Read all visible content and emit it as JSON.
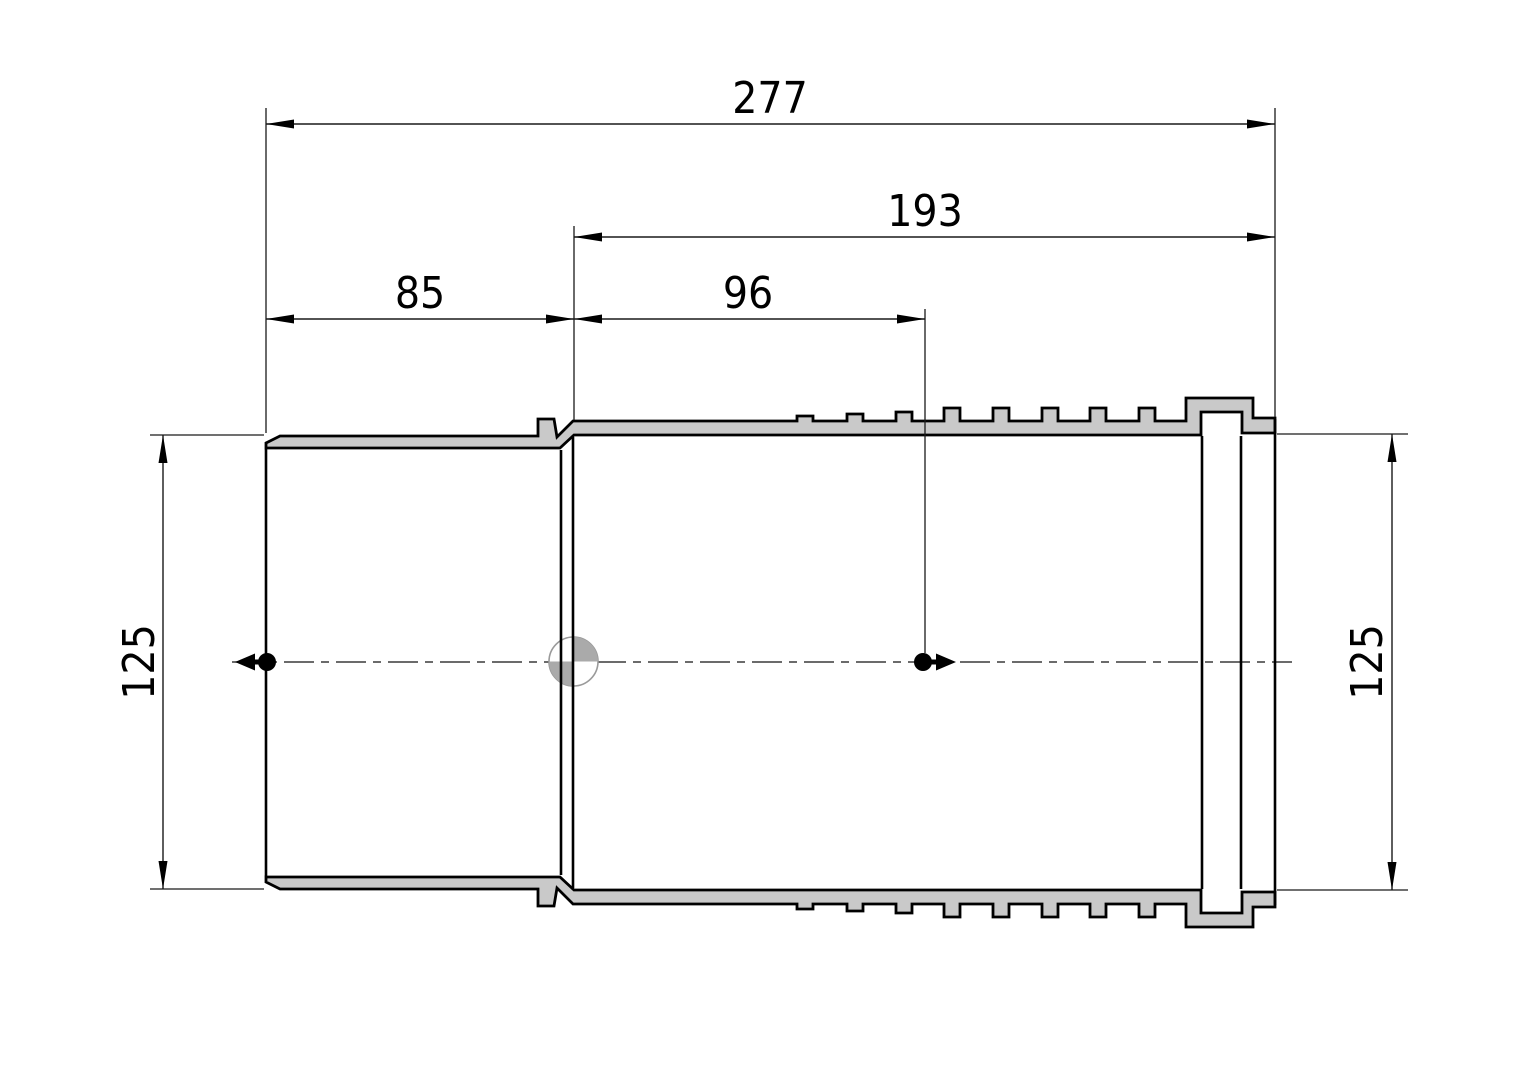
{
  "drawing": {
    "type": "technical-section-drawing",
    "subject": "pipe-adapter-sleeve-cross-section",
    "dimensions": {
      "overall_length": "277",
      "ribbed_section_length": "193",
      "socket_section_length": "85",
      "marker_offset_length": "96",
      "left_diameter": "125",
      "right_diameter": "125"
    },
    "colors": {
      "background": "#ffffff",
      "wall_fill": "#c9c9c9",
      "outline": "#000000",
      "dim_line": "#1a1a1a",
      "centerline": "#3a3a3a",
      "centroid_gray": "#aaaaaa",
      "centroid_ring": "#9a9a9a"
    }
  }
}
